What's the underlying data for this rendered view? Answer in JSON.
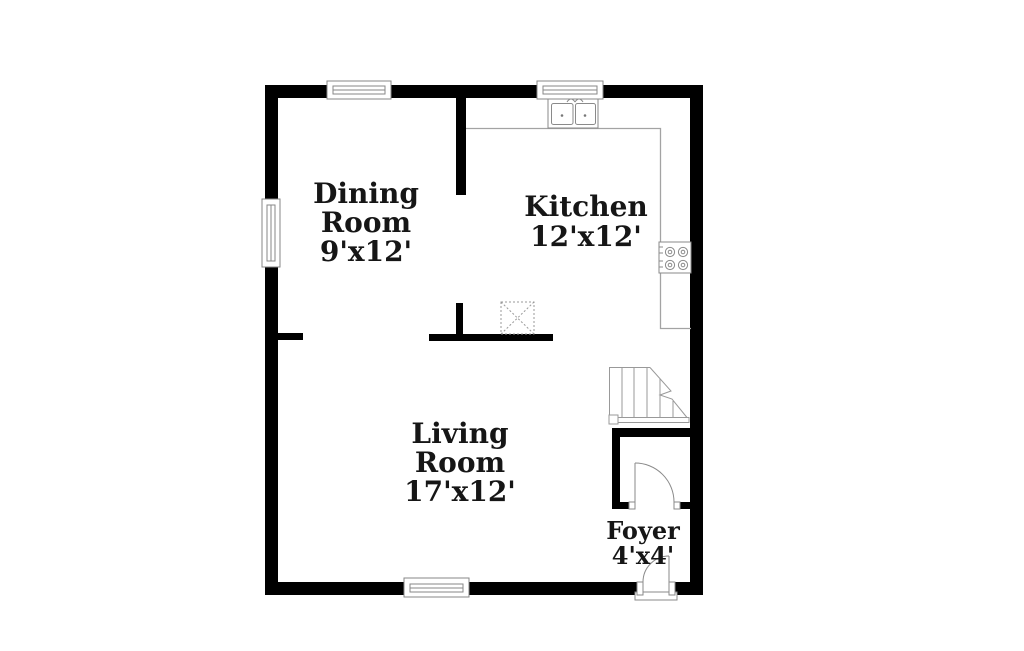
{
  "title": "First floor plan",
  "colors": {
    "background": "#ffffff",
    "walls": "#000000",
    "fixture_lines": "#999999",
    "window_lines": "#878787",
    "text": "#161616"
  },
  "rooms": [
    {
      "id": "dining-room",
      "name": "Dining Room",
      "dimensions": "9'x12'",
      "label_lines": [
        "Dining",
        "Room",
        "9'x12'"
      ]
    },
    {
      "id": "kitchen",
      "name": "Kitchen",
      "dimensions": "12'x12'",
      "label_lines": [
        "Kitchen",
        "12'x12'"
      ]
    },
    {
      "id": "living-room",
      "name": "Living Room",
      "dimensions": "17'x12'",
      "label_lines": [
        "Living",
        "Room",
        "17'x12'"
      ]
    },
    {
      "id": "foyer",
      "name": "Foyer",
      "dimensions": "4'x4'",
      "label_lines": [
        "Foyer",
        "4'x4'"
      ]
    }
  ],
  "fixtures": [
    {
      "name": "double-basin-sink",
      "room": "kitchen"
    },
    {
      "name": "four-burner-cooktop",
      "room": "kitchen"
    },
    {
      "name": "l-shaped-counter",
      "room": "kitchen"
    },
    {
      "name": "staircase",
      "room": "living-room"
    },
    {
      "name": "closet-door-swing",
      "room": "foyer"
    },
    {
      "name": "front-door-swing",
      "room": "foyer"
    },
    {
      "name": "dashed-x-marker",
      "room": "kitchen"
    },
    {
      "name": "window",
      "count": 4
    }
  ]
}
